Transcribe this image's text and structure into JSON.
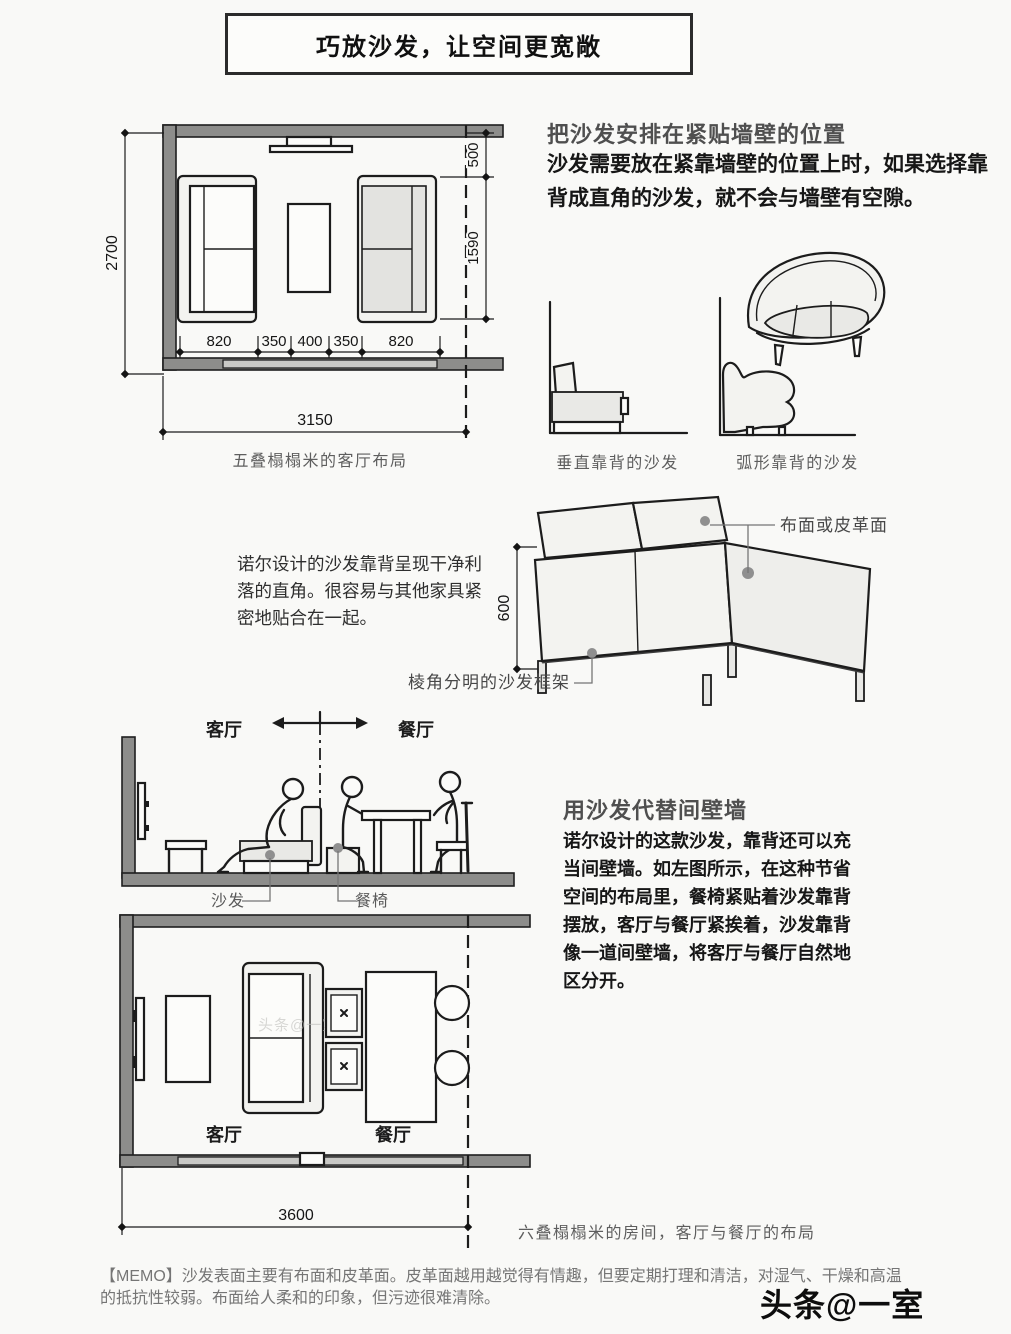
{
  "page": {
    "title": "巧放沙发，让空间更宽敞",
    "watermark": "头条@一室"
  },
  "top_plan": {
    "caption": "五叠榻榻米的客厅布局",
    "dims": {
      "room_height": "2700",
      "offset_top": "500",
      "sofa_span": "1590",
      "seg1": "820",
      "seg2": "350",
      "seg3": "400",
      "seg4": "350",
      "seg5": "820",
      "room_width": "3150"
    }
  },
  "wall_section": {
    "heading": "把沙发安排在紧贴墙壁的位置",
    "body": "沙发需要放在紧靠墙壁的位置上时，如果选择靠背成直角的沙发，就不会与墙壁有空隙。",
    "caption_straight": "垂直靠背的沙发",
    "caption_curved": "弧形靠背的沙发"
  },
  "sofa_detail": {
    "body": "诺尔设计的沙发靠背呈现干净利落的直角。很容易与其他家具紧密地贴合在一起。",
    "dim_height": "600",
    "label_surface": "布面或皮革面",
    "label_frame": "棱角分明的沙发框架"
  },
  "divider_section": {
    "label_living": "客厅",
    "label_dining": "餐厅",
    "label_sofa": "沙发",
    "label_chair": "餐椅",
    "heading": "用沙发代替间壁墙",
    "body": "诺尔设计的这款沙发，靠背还可以充当间壁墙。如左图所示，在这种节省空间的布局里，餐椅紧贴着沙发靠背摆放，客厅与餐厅紧挨着，沙发靠背像一道间壁墙，将客厅与餐厅自然地区分开。"
  },
  "bottom_plan": {
    "label_living": "客厅",
    "label_dining": "餐厅",
    "dim_width": "3600",
    "caption": "六叠榻榻米的房间，客厅与餐厅的布局"
  },
  "memo": {
    "text": "【MEMO】沙发表面主要有布面和皮革面。皮革面越用越觉得有情趣，但要定期打理和清洁，对湿气、干燥和高温的抵抗性较弱。布面给人柔和的印象，但污迹很难清除。"
  },
  "colors": {
    "wall_gray": "#8d8d8b",
    "line_black": "#1c1c1c",
    "fill_light": "#f3f3f0",
    "fill_shade": "#e3e3e0"
  }
}
